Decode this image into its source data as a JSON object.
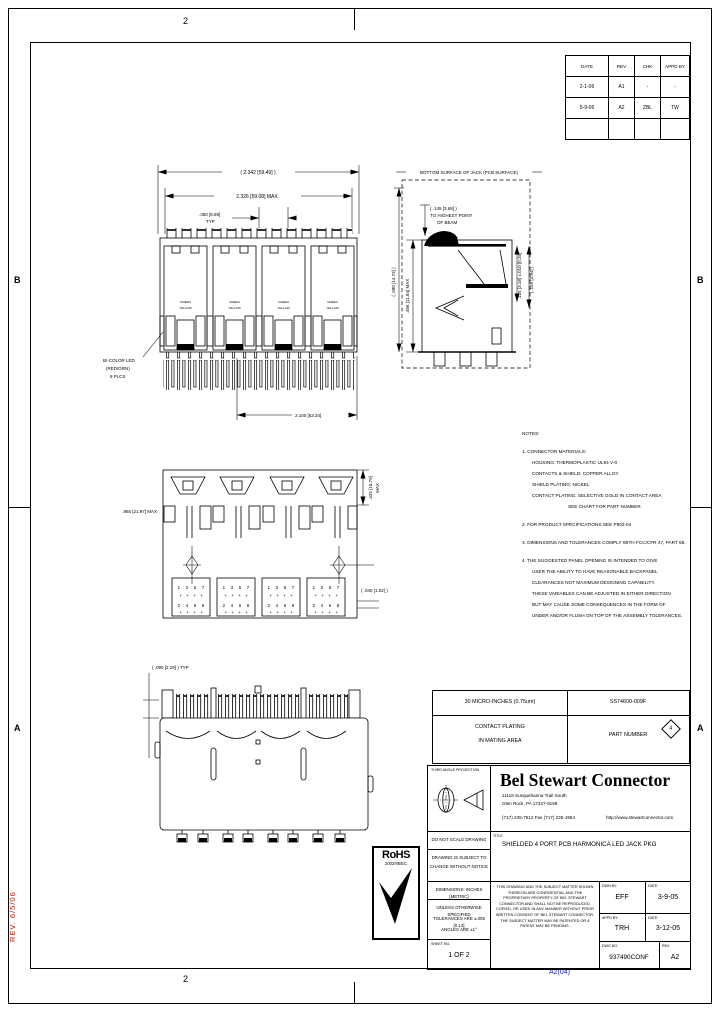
{
  "sheet": {
    "zone_b": "B",
    "zone_a": "A",
    "zone_2": "2",
    "stamp_red": "REV. 6/5/06",
    "blue_note": "A2(04)"
  },
  "revision_table": {
    "headers": [
      "DATE",
      "REV",
      "CHK",
      "APPD BY"
    ],
    "rows": [
      {
        "date": "2-1-06",
        "rev": "A1",
        "chk": "-",
        "appd": "-"
      },
      {
        "date": "5-9-06",
        "rev": "A2",
        "chk": "ZBL",
        "appd": "TW"
      }
    ]
  },
  "part_chart": {
    "plating_value": "30 MICRO-INCHES (0.75um)",
    "part_number": "SS74600-009F",
    "plating_label_1": "CONTACT PLATING",
    "plating_label_2": "IN MATING AREA",
    "part_number_label": "PART NUMBER",
    "flag": "4"
  },
  "notes": {
    "lines": [
      "NOTES:",
      "1. CONNECTOR MATERIALS:",
      "HOUSING: THERMOPLASTIC UL94 V-0",
      "CONTACTS & SHIELD: COPPER ALLOY",
      "SHIELD PLATING: NICKEL",
      "CONTACT PLATING: SELECTIVE GOLD IN CONTACT AREA",
      "SEE CHART FOR PART NUMBER",
      "2. FOR PRODUCT SPECIFICATIONS SEE P902-04",
      "3. DIMENSIONS AND TOLERANCES COMPLY WITH FCC/CFR 47, PART 68.",
      "4. THE SUGGESTED PANEL OPENING IS INTENDED TO GIVE",
      "USER THE ABILITY TO HAVE REASONABLE BACKPANEL",
      "CLEARANCES NOT MAXIMUM DESIGNING CAPABILITY.",
      "THESE VARIABLES CAN BE ADJUSTED IN EITHER DIRECTION",
      "BUT MAY CAUSE SOME CONSEQUENCES IN THE FORM OF",
      "UNDER AND/OR FLUSH ON TOP OF THE ASSEMBLY TOLERANCES."
    ]
  },
  "views": {
    "front": {
      "dim_overall": "( 2.342 [59.49] )",
      "dim_body_max": "2.326 [59.08] MAX",
      "dim_pitch": ".350 [8.89]",
      "dim_pitch_typ": "TYP",
      "dim_pins": "2.100 [53.34]",
      "callout_led_1": "BI-COLOR LED",
      "callout_led_2": "(RED/GRN)",
      "callout_led_3": "8 PLCS",
      "led_label_top": "GREEN",
      "led_label_bottom": "YELLOW"
    },
    "side": {
      "surface_label": "BOTTOM SURFACE OF JACK (PCB SURFACE)",
      "beam_dim_1": "( .145 [3.68] )",
      "beam_dim_2": "TO HIGHEST POINT",
      "beam_dim_3": "OF BEAM",
      "dim_left_outer": ".466 [11.84] MAX",
      "dim_left_inner": "( .580 [14.73] )",
      "dim_right_inner": ".125 [3.18] ±.010 [0.25]",
      "dim_right_outer": "( .155 [3.94] )"
    },
    "bottom": {
      "dim_left": ".865 [21.97] MAX",
      "dim_right_top_1": ".425 [10.79]",
      "dim_right_top_2": "MAX",
      "dim_right_mid": "( .040 [1.02] )",
      "pins_odd": "1 3 5 7",
      "pins_even": "2 4 6 8",
      "cross_row": "+ + + +"
    },
    "rear": {
      "dim_typ": "( .090 [2.29] ) TYP"
    }
  },
  "title_block": {
    "projection_label": "THIRD ANGLE PROJECTION",
    "company": "Bel Stewart Connector",
    "address_1": "11118 Susquehanna Trail South",
    "address_2": "Glen Rock, PA  17327-9199",
    "address_3": "(717) 235-7512   Fax (717) 235-1964",
    "website": "http://www.stewartconnector.com",
    "title_label": "TITLE",
    "title": "SHIELDED 4 PORT PCB HARMONICA LED JACK PKG",
    "do_not_scale": "DO NOT SCALE DRAWING",
    "subject_to_change_1": "DRAWING IS SUBJECT TO",
    "subject_to_change_2": "CHANGE WITHOUT NOTICE",
    "dimensions_note": "DIMENSIONS:  INCHES [METRIC]",
    "tolerance_note_1": "UNLESS OTHERWISE SPECIFIED",
    "tolerance_note_2": "TOLERANCES ARE ±.005 [0.13]",
    "tolerance_note_3": "ANGLES ARE ±1°",
    "sheet_label": "SHEET NO.",
    "sheet_value": "1 OF 2",
    "legal": "THIS DRAWING AND THE SUBJECT MATTER SHOWN THEREON ARE CONFIDENTIAL AND THE PROPRIETARY PROPERTY OF BEL STEWART CONNECTOR AND SHALL NOT BE REPRODUCED, COPIED, OR USED IN ANY MANNER WITHOUT PRIOR WRITTEN CONSENT OF BEL STEWART CONNECTOR.  THE SUBJECT MATTER MAY BE PATENTED OR A PATENT MAY BE PENDING.",
    "dwn_label": "DWN BY:",
    "dwn_value": "EFF",
    "dwn_date_label": "DATE:",
    "dwn_date": "3-9-05",
    "appd_label": "APPD BY:",
    "appd_value": "TRH",
    "appd_date_label": "DATE:",
    "appd_date": "3-12-05",
    "dwg_no_label": "DWG NO.",
    "dwg_no": "937490CONF",
    "rev_label": "REV.",
    "rev": "A2"
  },
  "rohs": {
    "name": "RoHS",
    "directive": "2002/95/EC"
  }
}
